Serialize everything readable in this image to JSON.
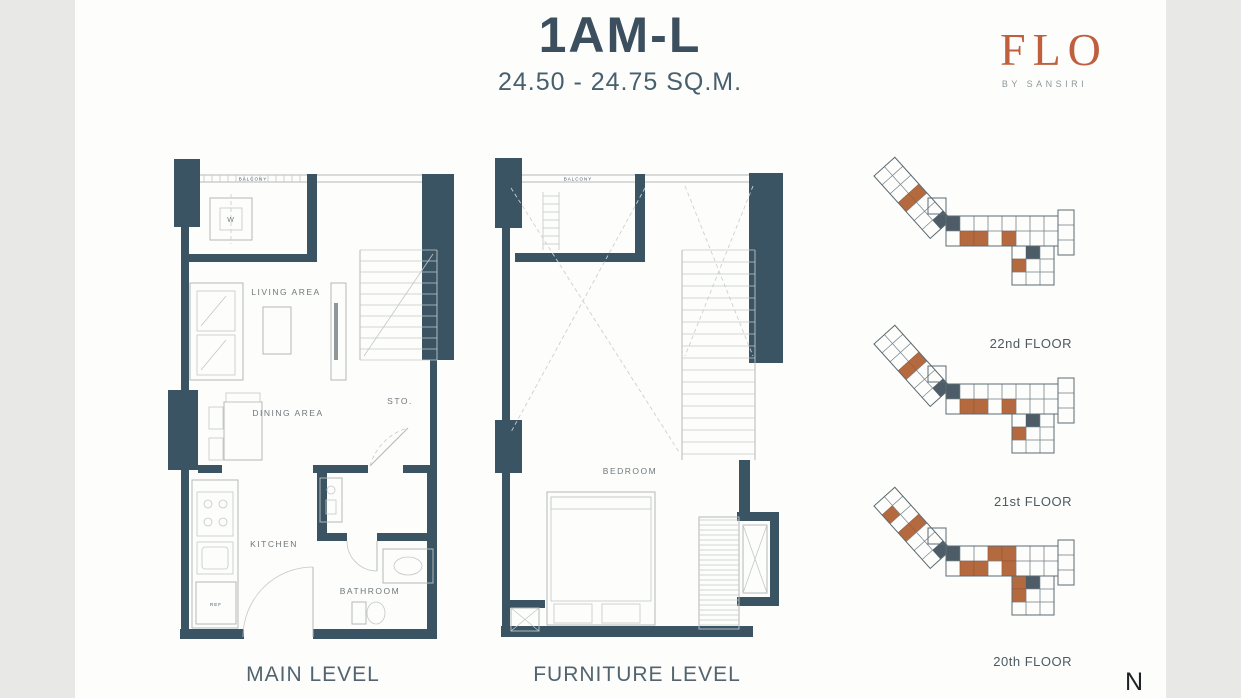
{
  "header": {
    "title": "1AM-L",
    "subtitle": "24.50 - 24.75 SQ.M."
  },
  "brand": {
    "logo": "FLO",
    "tagline": "BY SANSIRI"
  },
  "unit_plans": [
    {
      "label": "MAIN LEVEL",
      "rooms": {
        "balcony": "BALCONY",
        "washer": "W",
        "living": "LIVING AREA",
        "dining": "DINING AREA",
        "storage": "STO.",
        "kitchen": "KITCHEN",
        "bathroom": "BATHROOM",
        "fridge": "REF"
      }
    },
    {
      "label": "FURNITURE LEVEL",
      "rooms": {
        "balcony": "BALCONY",
        "bedroom": "BEDROOM"
      }
    }
  ],
  "keyplans": [
    {
      "label": "22nd FLOOR"
    },
    {
      "label": "21st FLOOR"
    },
    {
      "label": "20th FLOOR"
    }
  ],
  "compass": {
    "label": "N"
  },
  "colors": {
    "wall": "#3a5464",
    "brand": "#bf5f3e",
    "unit_highlight": "#b5693f",
    "background": "#e8e8e6",
    "page": "#fdfdfc",
    "title_text": "#3c4f5e"
  }
}
